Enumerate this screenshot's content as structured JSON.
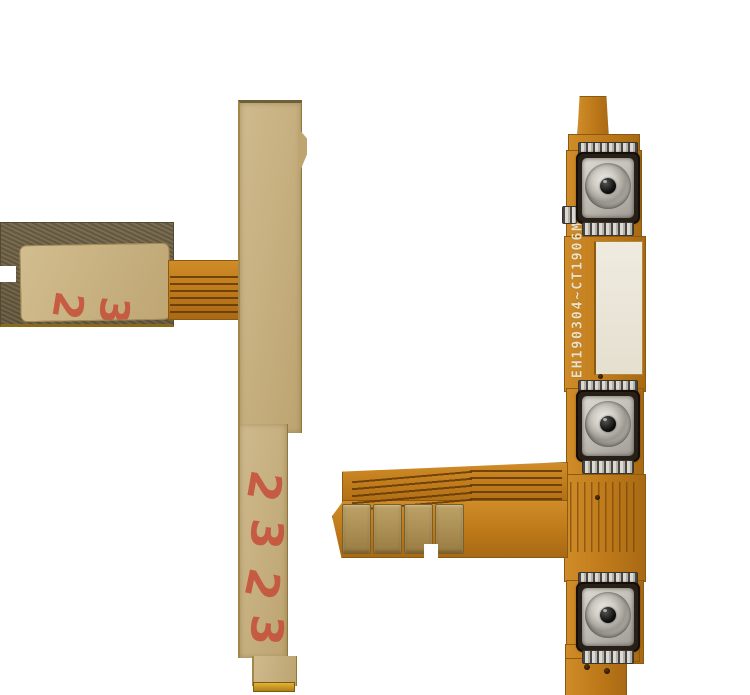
{
  "scene": {
    "description": "Product photo: two power / volume button flex cables for a smartphone on a plain white background",
    "background_color": "#ffffff"
  },
  "left_cable": {
    "side": "back side with tan adhesive backing and dark olive bracket arm",
    "adhesive_color": "#c6af7e",
    "arm_color": "#6c5f42",
    "red_stamp": {
      "color": "#c5503a",
      "strip_digits": [
        "2",
        "3",
        "2",
        "3"
      ],
      "pad_digits": [
        "2",
        "3"
      ]
    }
  },
  "right_cable": {
    "side": "front side showing three metal dome switches",
    "flex_color": "#bd7819",
    "marking": "EH190304~CT1906M",
    "marking_color": "#e9e0c8",
    "button_count": 3,
    "buttons": [
      {
        "name": "dome-switch-top"
      },
      {
        "name": "dome-switch-middle"
      },
      {
        "name": "dome-switch-bottom"
      }
    ],
    "connector_pad_count": 4
  }
}
